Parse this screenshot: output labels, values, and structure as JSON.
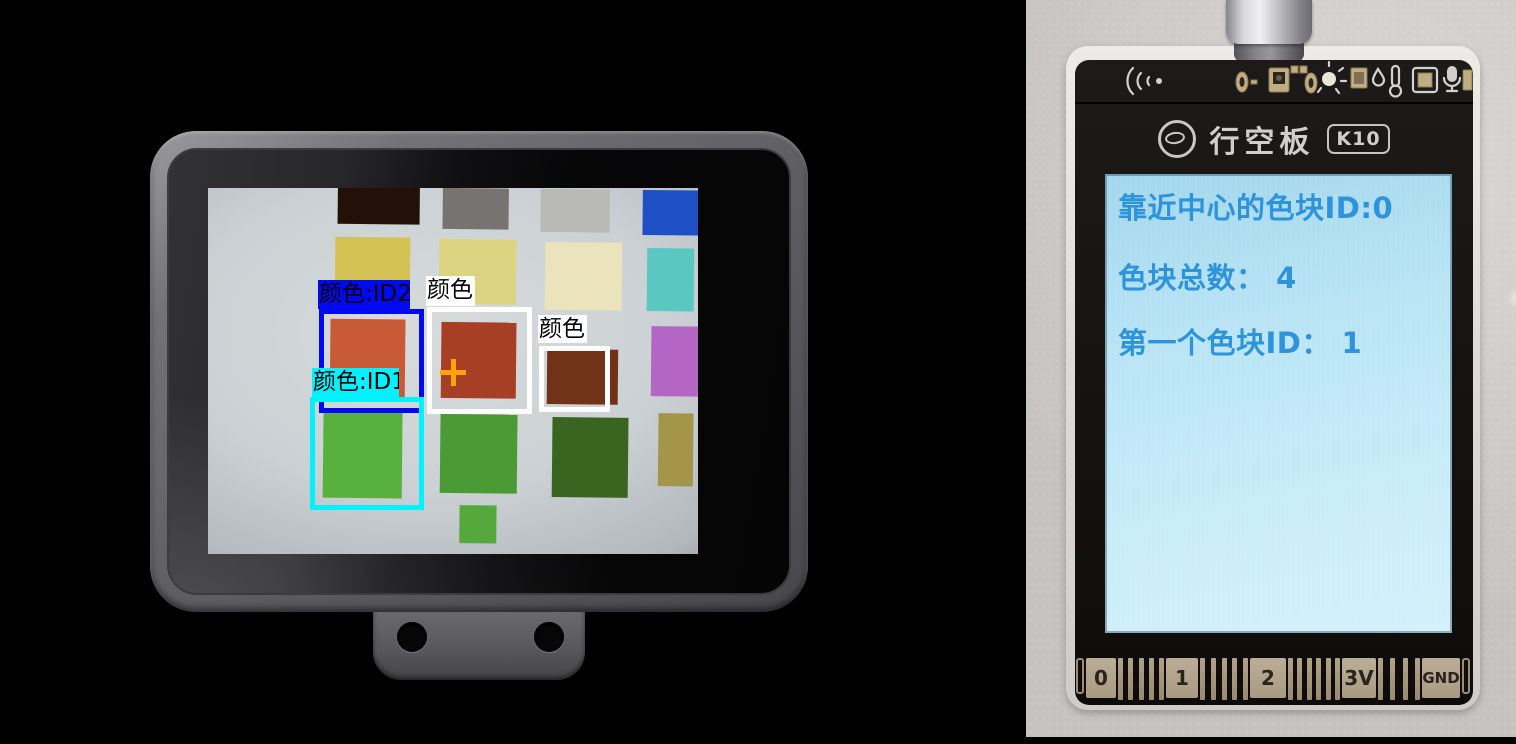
{
  "camera_view": {
    "background": "#ccd1d3",
    "swatches": [
      {
        "name": "dark-brown",
        "x": 128,
        "y": 0,
        "w": 82,
        "h": 37,
        "color": "#231008"
      },
      {
        "name": "gray",
        "x": 233,
        "y": 0,
        "w": 66,
        "h": 41,
        "color": "#767370"
      },
      {
        "name": "light-gray",
        "x": 331,
        "y": 0,
        "w": 69,
        "h": 43,
        "color": "#b9b9b5"
      },
      {
        "name": "blue",
        "x": 433,
        "y": 0,
        "w": 57,
        "h": 45,
        "color": "#1e4fc4"
      },
      {
        "name": "dark-yellow",
        "x": 126,
        "y": 50,
        "w": 75,
        "h": 50,
        "color": "#d4c254"
      },
      {
        "name": "pale-yellow",
        "x": 230,
        "y": 51,
        "w": 77,
        "h": 65,
        "color": "#ddd481"
      },
      {
        "name": "cream",
        "x": 336,
        "y": 53,
        "w": 77,
        "h": 68,
        "color": "#eae3bb"
      },
      {
        "name": "cyan",
        "x": 438,
        "y": 58,
        "w": 47,
        "h": 63,
        "color": "#5ac8c1"
      },
      {
        "name": "orange-red",
        "x": 122,
        "y": 132,
        "w": 75,
        "h": 81,
        "color": "#c85a38"
      },
      {
        "name": "dark-red",
        "x": 233,
        "y": 134,
        "w": 75,
        "h": 76,
        "color": "#a63f23"
      },
      {
        "name": "brown",
        "x": 339,
        "y": 160,
        "w": 71,
        "h": 55,
        "color": "#703317"
      },
      {
        "name": "purple",
        "x": 443,
        "y": 136,
        "w": 53,
        "h": 70,
        "color": "#b366c4"
      },
      {
        "name": "bright-green",
        "x": 116,
        "y": 225,
        "w": 79,
        "h": 86,
        "color": "#57b13c"
      },
      {
        "name": "medium-green",
        "x": 233,
        "y": 226,
        "w": 77,
        "h": 79,
        "color": "#4b9a36"
      },
      {
        "name": "dark-green",
        "x": 345,
        "y": 228,
        "w": 76,
        "h": 80,
        "color": "#3a6521"
      },
      {
        "name": "khaki",
        "x": 451,
        "y": 223,
        "w": 35,
        "h": 73,
        "color": "#a3964a"
      },
      {
        "name": "small-green",
        "x": 253,
        "y": 317,
        "w": 37,
        "h": 38,
        "color": "#55a93c"
      }
    ],
    "detections": [
      {
        "id": "id2",
        "label": "颜色:ID2",
        "label_bg": "#0009f2",
        "box_color": "#0009f2",
        "label_x": 110,
        "label_y": 92,
        "label_w": 92,
        "label_h": 29,
        "x": 111,
        "y": 121,
        "w": 105,
        "h": 104
      },
      {
        "id": "center",
        "label": "颜色",
        "label_bg": "#ffffff",
        "box_color": "#ffffff",
        "label_x": 218,
        "label_y": 88,
        "label_w": 49,
        "label_h": 30,
        "x": 219,
        "y": 119,
        "w": 105,
        "h": 107
      },
      {
        "id": "right",
        "label": "颜色",
        "label_bg": "#ffffff",
        "box_color": "#ffffff",
        "label_x": 330,
        "label_y": 127,
        "label_w": 49,
        "label_h": 28,
        "x": 331,
        "y": 158,
        "w": 71,
        "h": 66
      },
      {
        "id": "id1",
        "label": "颜色:ID1",
        "label_bg": "#00f2ff",
        "box_color": "#00f2ff",
        "label_x": 104,
        "label_y": 180,
        "label_w": 87,
        "label_h": 30,
        "x": 102,
        "y": 209,
        "w": 114,
        "h": 113
      }
    ],
    "crosshair": {
      "x": 245,
      "y": 184,
      "color": "#ffa20a"
    }
  },
  "board": {
    "logo_text": "行空板",
    "logo_badge": "K10",
    "screen_lines": [
      "靠近中心的色块ID:0",
      "色块总数： 4",
      "第一个色块ID： 1"
    ],
    "screen_text_color": "#2d93da",
    "screen_bg_color": "#bfe7f6",
    "top_icons": [
      "wifi-signal-icon",
      "pad-0-icon",
      "mems-mic-icon",
      "pad-0-icon",
      "light-sensor-icon",
      "chip-icon",
      "humidity-droplet-icon",
      "thermometer-icon",
      "soc-chip-icon",
      "microphone-icon",
      "component-icon"
    ],
    "connector": {
      "sequence": [
        {
          "type": "edge"
        },
        {
          "type": "pad",
          "label": "0",
          "w": 30
        },
        {
          "type": "fingers",
          "count": 5,
          "w": 46
        },
        {
          "type": "pad",
          "label": "1",
          "w": 32
        },
        {
          "type": "fingers",
          "count": 5,
          "w": 48
        },
        {
          "type": "pad",
          "label": "2",
          "w": 36
        },
        {
          "type": "fingers",
          "count": 6,
          "w": 52
        },
        {
          "type": "pad",
          "label": "3V",
          "w": 34
        },
        {
          "type": "fingers",
          "count": 4,
          "w": 42
        },
        {
          "type": "pad",
          "label": "GND",
          "w": 38
        },
        {
          "type": "edge"
        }
      ]
    }
  }
}
